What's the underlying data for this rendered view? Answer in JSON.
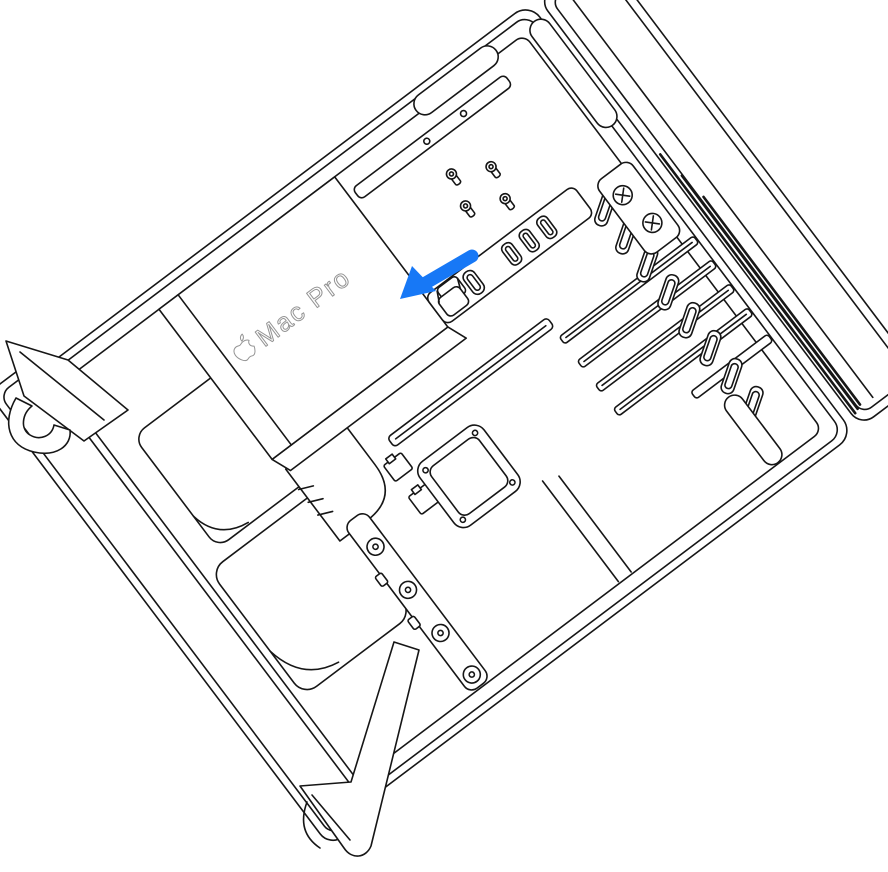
{
  "figure": {
    "device_label": "Mac Pro",
    "arrow_color": "#1778F6",
    "line_color": "#161616",
    "label_outline_color": "#949494",
    "background_color": "#FFFFFF",
    "icons": {
      "apple_logo": "apple-outline-glyph",
      "callout_arrow": "thick-arrow-pointing-down-left"
    }
  }
}
